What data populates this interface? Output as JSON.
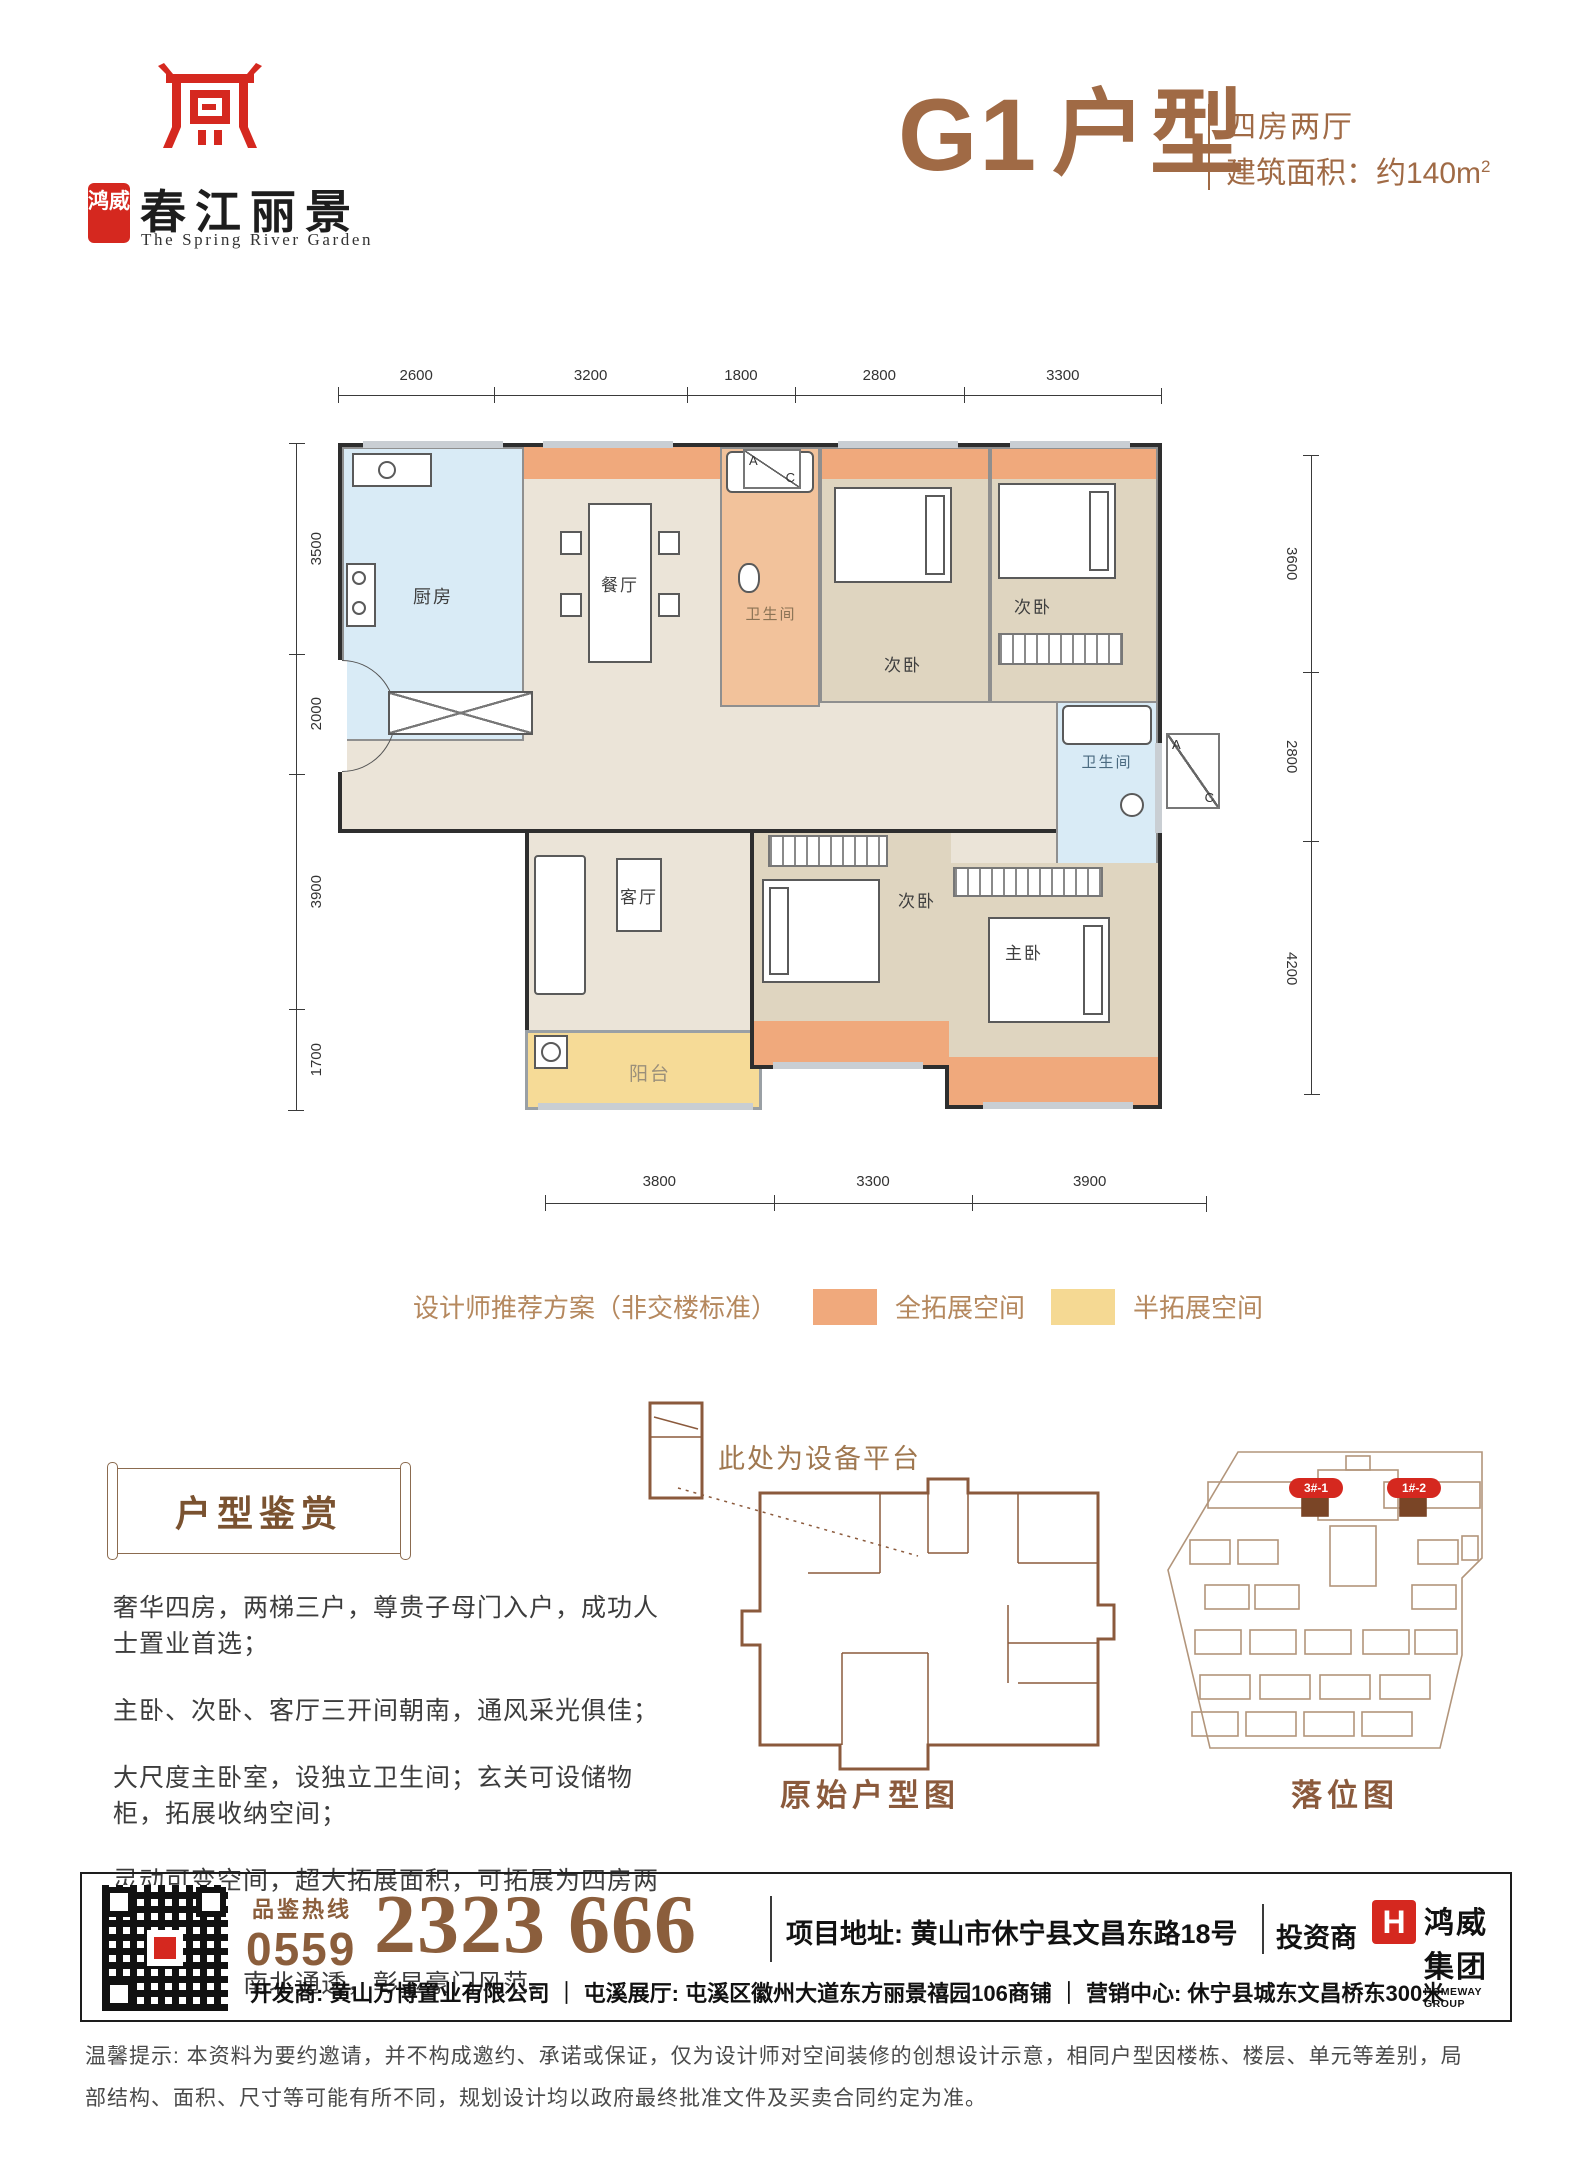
{
  "header": {
    "brand_seal": "鸿威",
    "brand_cn": "春江丽景",
    "brand_en": "The Spring River Garden",
    "unit_code": "G1",
    "unit_word": "户型",
    "unit_type": "四房两厅",
    "area_prefix": "建筑面积：",
    "area_value": "约140m",
    "area_sup": "2"
  },
  "floorplan": {
    "dims_top": [
      "2600",
      "3200",
      "1800",
      "2800",
      "3300"
    ],
    "dims_left": [
      "3500",
      "2000",
      "3900",
      "1700"
    ],
    "dims_right": [
      "3600",
      "2800",
      "4200"
    ],
    "dims_bottom": [
      "3800",
      "3300",
      "3900"
    ],
    "rooms": {
      "kitchen": "厨房",
      "dining": "餐厅",
      "bath_top": "卫生间",
      "bed_top_mid": "次卧",
      "bed_top_right": "次卧",
      "bath_master": "卫生间",
      "living": "客厅",
      "balcony": "阳台",
      "bed_bottom": "次卧",
      "master": "主卧"
    },
    "ac_letters": [
      "A",
      "C"
    ]
  },
  "legend": {
    "note": "设计师推荐方案（非交楼标准）",
    "items": [
      {
        "label": "全拓展空间",
        "color": "#F0A97C"
      },
      {
        "label": "半拓展空间",
        "color": "#F5D993"
      }
    ]
  },
  "appreciation": {
    "title": "户型鉴赏",
    "lines": [
      "奢华四房，两梯三户，尊贵子母门入户，成功人士置业首选；",
      "主卧、次卧、客厅三开间朝南，通风采光俱佳；",
      "大尺度主卧室，设独立卫生间；玄关可设储物柜，拓展收纳空间；",
      "灵动可变空间，超大拓展面积，可拓展为四房两厅两卫；",
      "户型方正，南北通透，彰显豪门风范。"
    ]
  },
  "original_plan": {
    "annotation": "此处为设备平台",
    "caption": "原始户型图"
  },
  "site_plan": {
    "caption": "落位图",
    "markers": [
      "3#-1",
      "1#-2"
    ]
  },
  "contact": {
    "hotline_label": "品鉴热线",
    "hotline_area": "0559",
    "hotline_number": "2323 666",
    "address_label": "项目地址:",
    "address": "黄山市休宁县文昌东路18号",
    "investor_label": "投资商",
    "investor_logo_letter": "H",
    "investor_name": "鸿威集团",
    "investor_en": "HOMEWAY GROUP",
    "dev_line": "开发商: 黄山万博置业有限公司 ｜ 屯溪展厅: 屯溪区徽州大道东方丽景禧园106商铺 ｜ 营销中心: 休宁县城东文昌桥东300米"
  },
  "disclaimer": {
    "lines": [
      "温馨提示: 本资料为要约邀请，并不构成邀约、承诺或保证，仅为设计师对空间装修的创想设计示意，相同户型因楼栋、楼层、单元等差别，局",
      "部结构、面积、尺寸等可能有所不同，规划设计均以政府最终批准文件及买卖合同约定为准。"
    ]
  }
}
